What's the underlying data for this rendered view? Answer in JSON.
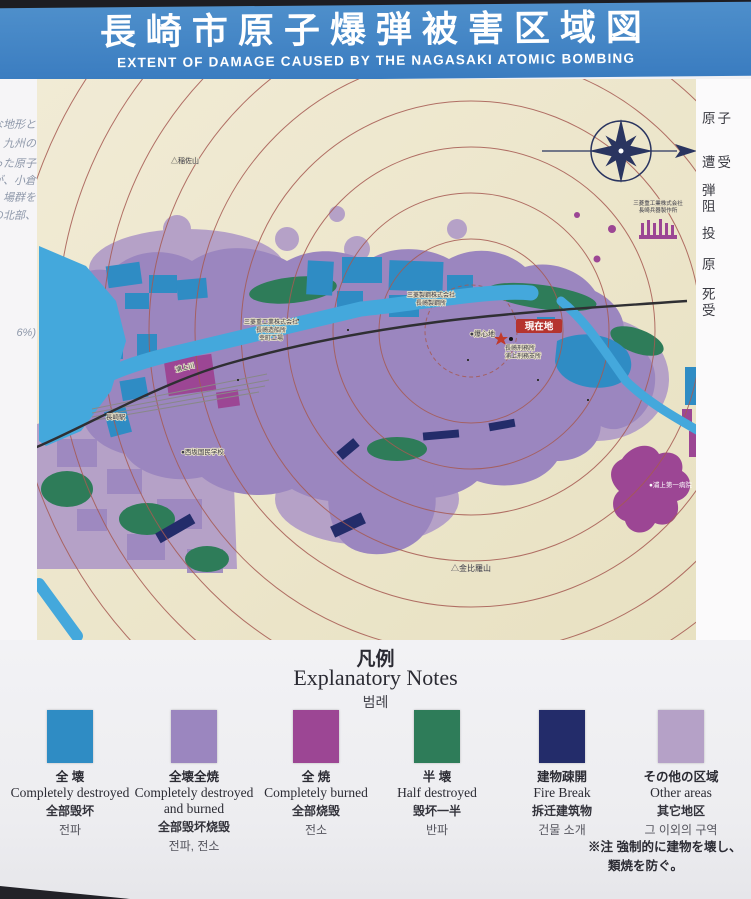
{
  "header": {
    "title_jp": "長崎市原子爆弾被害区域図",
    "title_en": "EXTENT OF DAMAGE CAUSED BY THE NAGASAKI ATOMIC BOMBING"
  },
  "side_panels": {
    "left_fragments": [
      "な地形と",
      "、九州の",
      "った原子",
      "が、小倉",
      "場群を",
      "の北部、",
      "6%)"
    ],
    "right_fragments": [
      "原子",
      "遭受",
      "弾",
      "阻",
      "投",
      "原",
      "死",
      "受"
    ]
  },
  "map": {
    "labels": {
      "current_location": "現在地",
      "hypocenter": "●爆心地",
      "prison_line1": "長崎刑務所",
      "prison_line2": "浦上刑務支所",
      "mt_inasa": "△稲佐山",
      "mt_konpira": "△金比羅山",
      "urakami_river": "浦上川",
      "nagasaki_station": "長崎駅",
      "nishizaka_school": "●西坂国民学校",
      "mitsubishi_steel_1": "三菱製鋼株式会社",
      "mitsubishi_steel_2": "長崎製鋼所",
      "mitsubishi_ship_1": "三菱重工業株式会社",
      "mitsubishi_ship_2": "長崎造船所",
      "mitsubishi_ship_3": "幸町工場",
      "mitsubishi_arms_1": "三菱重工業株式会社",
      "mitsubishi_arms_2": "長崎兵器製作所",
      "urakami_hospital": "●浦上第一病院"
    },
    "colors": {
      "title_bar": "#3d82c4",
      "map_cream": "#ece4c6",
      "ring_red": "#a65a52",
      "water": "#44a8dc",
      "destroyed_blue": "#2f8cc4",
      "destroyed_burned_purple": "#9b86bf",
      "burned_magenta": "#9c4694",
      "half_destroyed_green": "#2e7c59",
      "firebreak_navy": "#232c6a",
      "other_lavender": "#b5a1c7"
    }
  },
  "legend": {
    "title_jp": "凡例",
    "title_en": "Explanatory Notes",
    "title_kr": "범례",
    "items": [
      {
        "jp": "全 壊",
        "en": "Completely destroyed",
        "zh": "全部毁坏",
        "kr": "전파",
        "color": "#2f8cc4"
      },
      {
        "jp": "全壊全焼",
        "en": "Completely destroyed and burned",
        "zh": "全部毁坏烧毁",
        "kr": "전파, 전소",
        "color": "#9b86bf"
      },
      {
        "jp": "全 焼",
        "en": "Completely burned",
        "zh": "全部烧毁",
        "kr": "전소",
        "color": "#9c4694"
      },
      {
        "jp": "半 壊",
        "en": "Half destroyed",
        "zh": "毁坏一半",
        "kr": "반파",
        "color": "#2e7c59"
      },
      {
        "jp": "建物疎開",
        "en": "Fire Break",
        "zh": "拆迁建筑物",
        "kr": "건물 소개",
        "color": "#232c6a"
      },
      {
        "jp": "その他の区域",
        "en": "Other areas",
        "zh": "其它地区",
        "kr": "그 이외의 구역",
        "color": "#b5a1c7"
      }
    ],
    "note_line1": "※注 強制的に建物を壊し、",
    "note_line2": "類焼を防ぐ。"
  }
}
